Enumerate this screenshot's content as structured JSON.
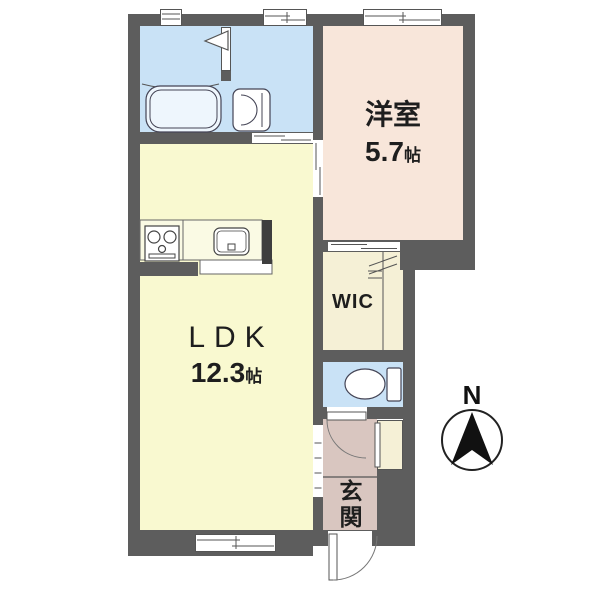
{
  "plan": {
    "rooms": {
      "bedroom": {
        "name": "洋室",
        "size": "5.7",
        "unit": "帖"
      },
      "ldk": {
        "name": "LDK",
        "size": "12.3",
        "unit": "帖"
      },
      "wic": {
        "name": "WIC"
      },
      "entrance": {
        "name": "玄関"
      }
    },
    "compass": {
      "north": "N"
    },
    "fixtures": [
      "bathtub",
      "washbasin",
      "gas-stove",
      "kitchen-sink",
      "toilet-bowl",
      "compass-north"
    ],
    "openings": [
      "sliding-door-washroom",
      "sliding-door-bedroom",
      "sliding-door-wic",
      "open-doorway-hall",
      "hinged-door-toilet",
      "hinged-door-entrance",
      "window-bath",
      "window-washroom",
      "window-bedroom",
      "window-ldk"
    ],
    "colors": {
      "wall": "#5d5d5d",
      "water_room_floor": "#c9e2f6",
      "bedroom_floor": "#f8e6da",
      "ldk_floor": "#f9f9d0",
      "wic_floor": "#f5f0d6",
      "entrance_floor": "#d9c6c0",
      "fixture_outline": "#444444"
    }
  }
}
